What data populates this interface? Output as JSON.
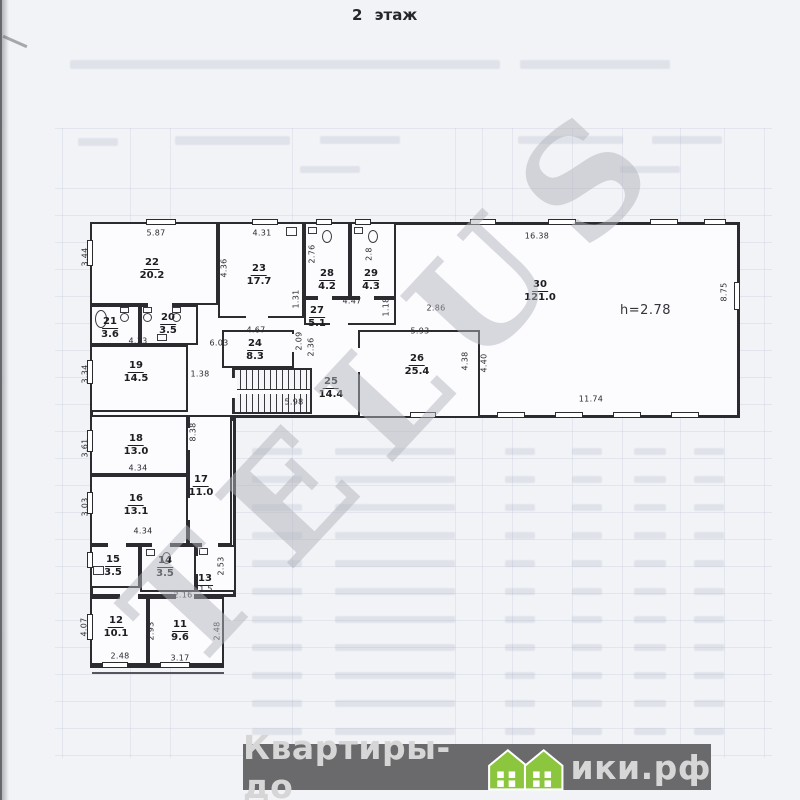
{
  "page": {
    "title": "2 этаж"
  },
  "watermark": {
    "text": "TELUS"
  },
  "logo": {
    "prefix": "Квартиры-до",
    "suffix": "ики.рф",
    "house_color": "#8cc63e",
    "bar_color": "#6a6a6d"
  },
  "plan": {
    "annotations": [
      {
        "text": "h=2.78",
        "x": 620,
        "y": 303
      }
    ],
    "footprint": [
      {
        "x": 90,
        "y": 222,
        "w": 650,
        "h": 196
      },
      {
        "x": 90,
        "y": 418,
        "w": 146,
        "h": 179
      },
      {
        "x": 90,
        "y": 597,
        "w": 134,
        "h": 71
      }
    ],
    "stairs": {
      "x": 232,
      "y": 368,
      "w": 80,
      "h": 46
    },
    "rooms": [
      {
        "num": "22",
        "area": "20.2",
        "x": 90,
        "y": 222,
        "w": 128,
        "h": 83,
        "lx": 152,
        "ly": 250
      },
      {
        "num": "23",
        "area": "17.7",
        "x": 218,
        "y": 222,
        "w": 86,
        "h": 96,
        "lx": 259,
        "ly": 256
      },
      {
        "num": "28",
        "area": "4.2",
        "x": 304,
        "y": 222,
        "w": 46,
        "h": 76,
        "lx": 327,
        "ly": 261
      },
      {
        "num": "29",
        "area": "4.3",
        "x": 350,
        "y": 222,
        "w": 46,
        "h": 76,
        "lx": 371,
        "ly": 261
      },
      {
        "num": "27",
        "area": "5.1",
        "x": 304,
        "y": 298,
        "w": 92,
        "h": 27,
        "lx": 317,
        "ly": 298
      },
      {
        "num": "30",
        "area": "121.0",
        "x": 0,
        "y": 0,
        "w": 0,
        "h": 0,
        "lx": 540,
        "ly": 272
      },
      {
        "num": "26",
        "area": "25.4",
        "x": 358,
        "y": 330,
        "w": 122,
        "h": 88,
        "lx": 417,
        "ly": 346
      },
      {
        "num": "24",
        "area": "8.3",
        "x": 222,
        "y": 330,
        "w": 72,
        "h": 38,
        "lx": 255,
        "ly": 331
      },
      {
        "num": "25",
        "area": "14.4",
        "x": 0,
        "y": 0,
        "w": 0,
        "h": 0,
        "lx": 331,
        "ly": 369
      },
      {
        "num": "21",
        "area": "3.6",
        "x": 90,
        "y": 305,
        "w": 50,
        "h": 40,
        "lx": 110,
        "ly": 309
      },
      {
        "num": "20",
        "area": "3.5",
        "x": 140,
        "y": 305,
        "w": 58,
        "h": 40,
        "lx": 168,
        "ly": 305
      },
      {
        "num": "19",
        "area": "14.5",
        "x": 90,
        "y": 345,
        "w": 98,
        "h": 67,
        "lx": 136,
        "ly": 353
      },
      {
        "num": "18",
        "area": "13.0",
        "x": 90,
        "y": 415,
        "w": 98,
        "h": 60,
        "lx": 136,
        "ly": 426
      },
      {
        "num": "16",
        "area": "13.1",
        "x": 90,
        "y": 475,
        "w": 98,
        "h": 70,
        "lx": 136,
        "ly": 486
      },
      {
        "num": "17",
        "area": "11.0",
        "x": 188,
        "y": 415,
        "w": 44,
        "h": 130,
        "lx": 201,
        "ly": 467
      },
      {
        "num": "15",
        "area": "3.5",
        "x": 90,
        "y": 545,
        "w": 50,
        "h": 43,
        "lx": 113,
        "ly": 547
      },
      {
        "num": "14",
        "area": "3.5",
        "x": 140,
        "y": 545,
        "w": 56,
        "h": 47,
        "lx": 165,
        "ly": 548
      },
      {
        "num": "13",
        "area": "",
        "x": 196,
        "y": 545,
        "w": 40,
        "h": 47,
        "lx": 205,
        "ly": 566
      },
      {
        "num": "12",
        "area": "10.1",
        "x": 90,
        "y": 597,
        "w": 58,
        "h": 68,
        "lx": 116,
        "ly": 608
      },
      {
        "num": "11",
        "area": "9.6",
        "x": 148,
        "y": 597,
        "w": 76,
        "h": 68,
        "lx": 180,
        "ly": 612
      }
    ],
    "dims": [
      {
        "t": "5.87",
        "x": 156,
        "y": 233
      },
      {
        "t": "4.31",
        "x": 262,
        "y": 233
      },
      {
        "t": "16.38",
        "x": 537,
        "y": 236
      },
      {
        "t": "2.86",
        "x": 436,
        "y": 308
      },
      {
        "t": "4.47",
        "x": 352,
        "y": 301
      },
      {
        "t": "1.38",
        "x": 200,
        "y": 374
      },
      {
        "t": "4.67",
        "x": 256,
        "y": 330
      },
      {
        "t": "6.03",
        "x": 219,
        "y": 343
      },
      {
        "t": "5.93",
        "x": 420,
        "y": 331
      },
      {
        "t": "5.98",
        "x": 294,
        "y": 402
      },
      {
        "t": "11.74",
        "x": 591,
        "y": 399
      },
      {
        "t": "4.33",
        "x": 138,
        "y": 341
      },
      {
        "t": "4.34",
        "x": 138,
        "y": 468
      },
      {
        "t": "4.34",
        "x": 143,
        "y": 531
      },
      {
        "t": "2.16",
        "x": 183,
        "y": 595
      },
      {
        "t": "1.5",
        "x": 206,
        "y": 589
      },
      {
        "t": "2.48",
        "x": 120,
        "y": 656
      },
      {
        "t": "3.17",
        "x": 180,
        "y": 658
      },
      {
        "t": "3.44",
        "x": 85,
        "y": 257,
        "v": 1
      },
      {
        "t": "4.36",
        "x": 224,
        "y": 268,
        "v": 1
      },
      {
        "t": "2.76",
        "x": 312,
        "y": 254,
        "v": 1
      },
      {
        "t": "2.8",
        "x": 369,
        "y": 254,
        "v": 1
      },
      {
        "t": "1.31",
        "x": 296,
        "y": 299,
        "v": 1
      },
      {
        "t": "1.18",
        "x": 386,
        "y": 307,
        "v": 1
      },
      {
        "t": "8.75",
        "x": 724,
        "y": 292,
        "v": 1
      },
      {
        "t": "2.09",
        "x": 299,
        "y": 341,
        "v": 1
      },
      {
        "t": "2.36",
        "x": 311,
        "y": 347,
        "v": 1
      },
      {
        "t": "4.38",
        "x": 465,
        "y": 361,
        "v": 1
      },
      {
        "t": "4.40",
        "x": 484,
        "y": 363,
        "v": 1
      },
      {
        "t": "3.34",
        "x": 85,
        "y": 374,
        "v": 1
      },
      {
        "t": "3.61",
        "x": 85,
        "y": 448,
        "v": 1
      },
      {
        "t": "3.03",
        "x": 85,
        "y": 507,
        "v": 1
      },
      {
        "t": "8.38",
        "x": 193,
        "y": 432,
        "v": 1
      },
      {
        "t": "2.53",
        "x": 221,
        "y": 566,
        "v": 1
      },
      {
        "t": "4.07",
        "x": 84,
        "y": 627,
        "v": 1
      },
      {
        "t": "2.93",
        "x": 151,
        "y": 631,
        "v": 1
      },
      {
        "t": "2.48",
        "x": 217,
        "y": 631,
        "v": 1
      }
    ],
    "windows": [
      {
        "x": 146,
        "y": 219,
        "w": 30,
        "h": 6
      },
      {
        "x": 252,
        "y": 219,
        "w": 26,
        "h": 6
      },
      {
        "x": 316,
        "y": 219,
        "w": 16,
        "h": 6
      },
      {
        "x": 355,
        "y": 219,
        "w": 16,
        "h": 6
      },
      {
        "x": 470,
        "y": 219,
        "w": 26,
        "h": 6
      },
      {
        "x": 548,
        "y": 219,
        "w": 28,
        "h": 6
      },
      {
        "x": 650,
        "y": 219,
        "w": 28,
        "h": 6
      },
      {
        "x": 704,
        "y": 219,
        "w": 22,
        "h": 6
      },
      {
        "x": 87,
        "y": 240,
        "w": 6,
        "h": 26
      },
      {
        "x": 87,
        "y": 360,
        "w": 6,
        "h": 24
      },
      {
        "x": 87,
        "y": 430,
        "w": 6,
        "h": 22
      },
      {
        "x": 87,
        "y": 492,
        "w": 6,
        "h": 22
      },
      {
        "x": 87,
        "y": 552,
        "w": 6,
        "h": 16
      },
      {
        "x": 87,
        "y": 614,
        "w": 6,
        "h": 26
      },
      {
        "x": 410,
        "y": 412,
        "w": 26,
        "h": 6
      },
      {
        "x": 497,
        "y": 412,
        "w": 28,
        "h": 6
      },
      {
        "x": 555,
        "y": 412,
        "w": 28,
        "h": 6
      },
      {
        "x": 613,
        "y": 412,
        "w": 28,
        "h": 6
      },
      {
        "x": 671,
        "y": 412,
        "w": 28,
        "h": 6
      },
      {
        "x": 734,
        "y": 282,
        "w": 6,
        "h": 28
      },
      {
        "x": 102,
        "y": 662,
        "w": 26,
        "h": 6
      },
      {
        "x": 160,
        "y": 662,
        "w": 30,
        "h": 6
      }
    ],
    "doors": [
      {
        "x": 148,
        "y": 302,
        "w": 24,
        "h": 6
      },
      {
        "x": 246,
        "y": 315,
        "w": 22,
        "h": 6
      },
      {
        "x": 318,
        "y": 294,
        "w": 14,
        "h": 6
      },
      {
        "x": 360,
        "y": 294,
        "w": 14,
        "h": 6
      },
      {
        "x": 330,
        "y": 321,
        "w": 18,
        "h": 6
      },
      {
        "x": 188,
        "y": 390,
        "w": 5,
        "h": 22
      },
      {
        "x": 188,
        "y": 428,
        "w": 5,
        "h": 22
      },
      {
        "x": 188,
        "y": 498,
        "w": 5,
        "h": 22
      },
      {
        "x": 108,
        "y": 542,
        "w": 18,
        "h": 6
      },
      {
        "x": 152,
        "y": 542,
        "w": 18,
        "h": 6
      },
      {
        "x": 202,
        "y": 542,
        "w": 16,
        "h": 6
      },
      {
        "x": 120,
        "y": 594,
        "w": 18,
        "h": 6
      },
      {
        "x": 176,
        "y": 594,
        "w": 18,
        "h": 6
      },
      {
        "x": 358,
        "y": 348,
        "w": 5,
        "h": 24
      },
      {
        "x": 292,
        "y": 334,
        "w": 5,
        "h": 18
      },
      {
        "x": 232,
        "y": 378,
        "w": 5,
        "h": 20
      },
      {
        "x": 196,
        "y": 556,
        "w": 5,
        "h": 18
      }
    ],
    "fixtures": [
      {
        "e": 1,
        "x": 95,
        "y": 310,
        "w": 12,
        "h": 18
      },
      {
        "e": 0,
        "x": 120,
        "y": 307,
        "w": 9,
        "h": 6
      },
      {
        "e": 1,
        "x": 120,
        "y": 313,
        "w": 9,
        "h": 9
      },
      {
        "e": 0,
        "x": 143,
        "y": 307,
        "w": 9,
        "h": 6
      },
      {
        "e": 1,
        "x": 143,
        "y": 313,
        "w": 9,
        "h": 9
      },
      {
        "e": 0,
        "x": 172,
        "y": 307,
        "w": 9,
        "h": 6
      },
      {
        "e": 1,
        "x": 172,
        "y": 313,
        "w": 9,
        "h": 9
      },
      {
        "e": 0,
        "x": 157,
        "y": 334,
        "w": 10,
        "h": 7
      },
      {
        "e": 0,
        "x": 308,
        "y": 227,
        "w": 9,
        "h": 7
      },
      {
        "e": 1,
        "x": 322,
        "y": 230,
        "w": 10,
        "h": 13
      },
      {
        "e": 0,
        "x": 354,
        "y": 227,
        "w": 9,
        "h": 7
      },
      {
        "e": 1,
        "x": 368,
        "y": 230,
        "w": 10,
        "h": 13
      },
      {
        "e": 0,
        "x": 286,
        "y": 227,
        "w": 11,
        "h": 9
      },
      {
        "e": 0,
        "x": 146,
        "y": 549,
        "w": 9,
        "h": 7
      },
      {
        "e": 1,
        "x": 162,
        "y": 552,
        "w": 9,
        "h": 12
      },
      {
        "e": 0,
        "x": 93,
        "y": 566,
        "w": 11,
        "h": 9
      },
      {
        "e": 0,
        "x": 199,
        "y": 548,
        "w": 9,
        "h": 7
      }
    ],
    "extra_lines": [
      {
        "x": 92,
        "y": 672,
        "w": 132,
        "h": 2
      }
    ]
  }
}
